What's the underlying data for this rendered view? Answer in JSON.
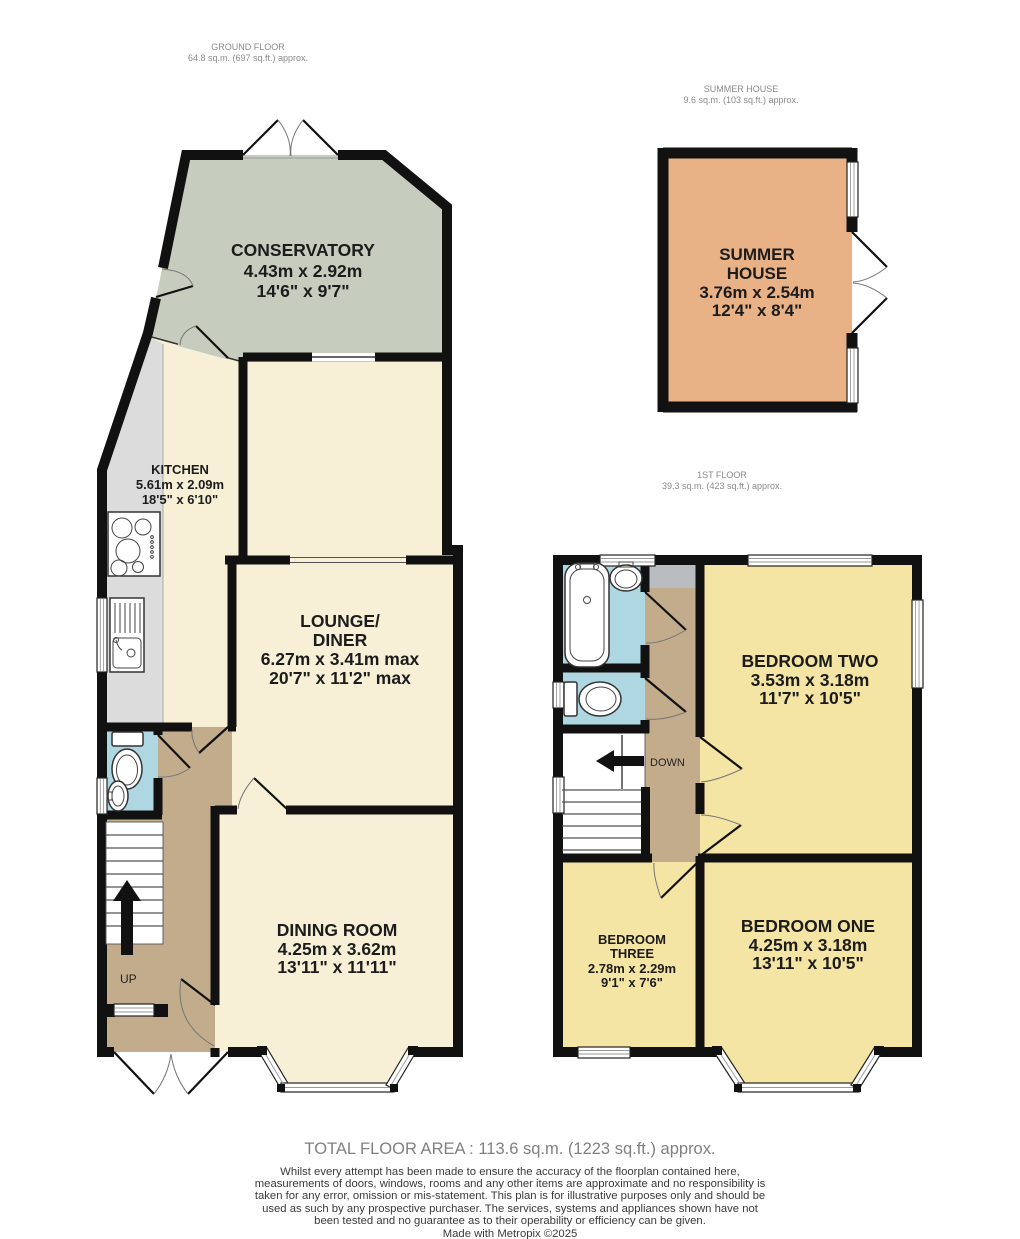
{
  "headers": {
    "ground": {
      "title": "GROUND FLOOR",
      "area": "64.8 sq.m. (697 sq.ft.) approx."
    },
    "summer": {
      "title": "SUMMER HOUSE",
      "area": "9.6 sq.m. (103 sq.ft.) approx."
    },
    "first": {
      "title": "1ST FLOOR",
      "area": "39.3 sq.m. (423 sq.ft.) approx."
    }
  },
  "rooms": {
    "conservatory": {
      "name": "CONSERVATORY",
      "metric": "4.43m  x 2.92m",
      "imperial": "14'6\"  x 9'7\""
    },
    "kitchen": {
      "name": "KITCHEN",
      "metric": "5.61m  x 2.09m",
      "imperial": "18'5\"  x 6'10\""
    },
    "lounge_diner": {
      "name1": "LOUNGE/",
      "name2": "DINER",
      "metric": "6.27m  x 3.41m max",
      "imperial": "20'7\"  x 11'2\" max"
    },
    "dining": {
      "name": "DINING ROOM",
      "metric": "4.25m  x 3.62m",
      "imperial": "13'11\"  x 11'11\""
    },
    "summer_house": {
      "name1": "SUMMER",
      "name2": "HOUSE",
      "metric": "3.76m  x 2.54m",
      "imperial": "12'4\"  x 8'4\""
    },
    "bedroom_two": {
      "name": "BEDROOM TWO",
      "metric": "3.53m  x 3.18m",
      "imperial": "11'7\"  x 10'5\""
    },
    "bedroom_three": {
      "name1": "BEDROOM",
      "name2": "THREE",
      "metric": "2.78m  x 2.29m",
      "imperial": "9'1\"  x 7'6\""
    },
    "bedroom_one": {
      "name": "BEDROOM ONE",
      "metric": "4.25m  x 3.18m",
      "imperial": "13'11\"  x 10'5\""
    }
  },
  "stairs": {
    "up": "UP",
    "down": "DOWN"
  },
  "footer": {
    "total_area": "TOTAL FLOOR AREA : 113.6 sq.m. (1223 sq.ft.) approx.",
    "disclaimer": "Whilst every attempt has been made to ensure the accuracy of the floorplan contained here, measurements of doors, windows, rooms and any other items are approximate and no responsibility is taken for any error, omission or mis-statement. This plan is for illustrative purposes only and should be used as such by any prospective purchaser. The services, systems and appliances shown have not been tested and no guarantee as to their operability or efficiency can be given.",
    "credit": "Made with Metropix ©2025"
  },
  "colors": {
    "wall": "#111111",
    "conservatory": "#c6cdbe",
    "cream": "#f7f0d7",
    "counter_gray": "#dcdcdc",
    "hall_tan": "#c3ac8b",
    "bathroom_blue": "#aed7e2",
    "bedroom_yellow": "#f5e5a4",
    "summer_orange": "#e9b286",
    "cupboard_gray": "#b9bdc0"
  }
}
